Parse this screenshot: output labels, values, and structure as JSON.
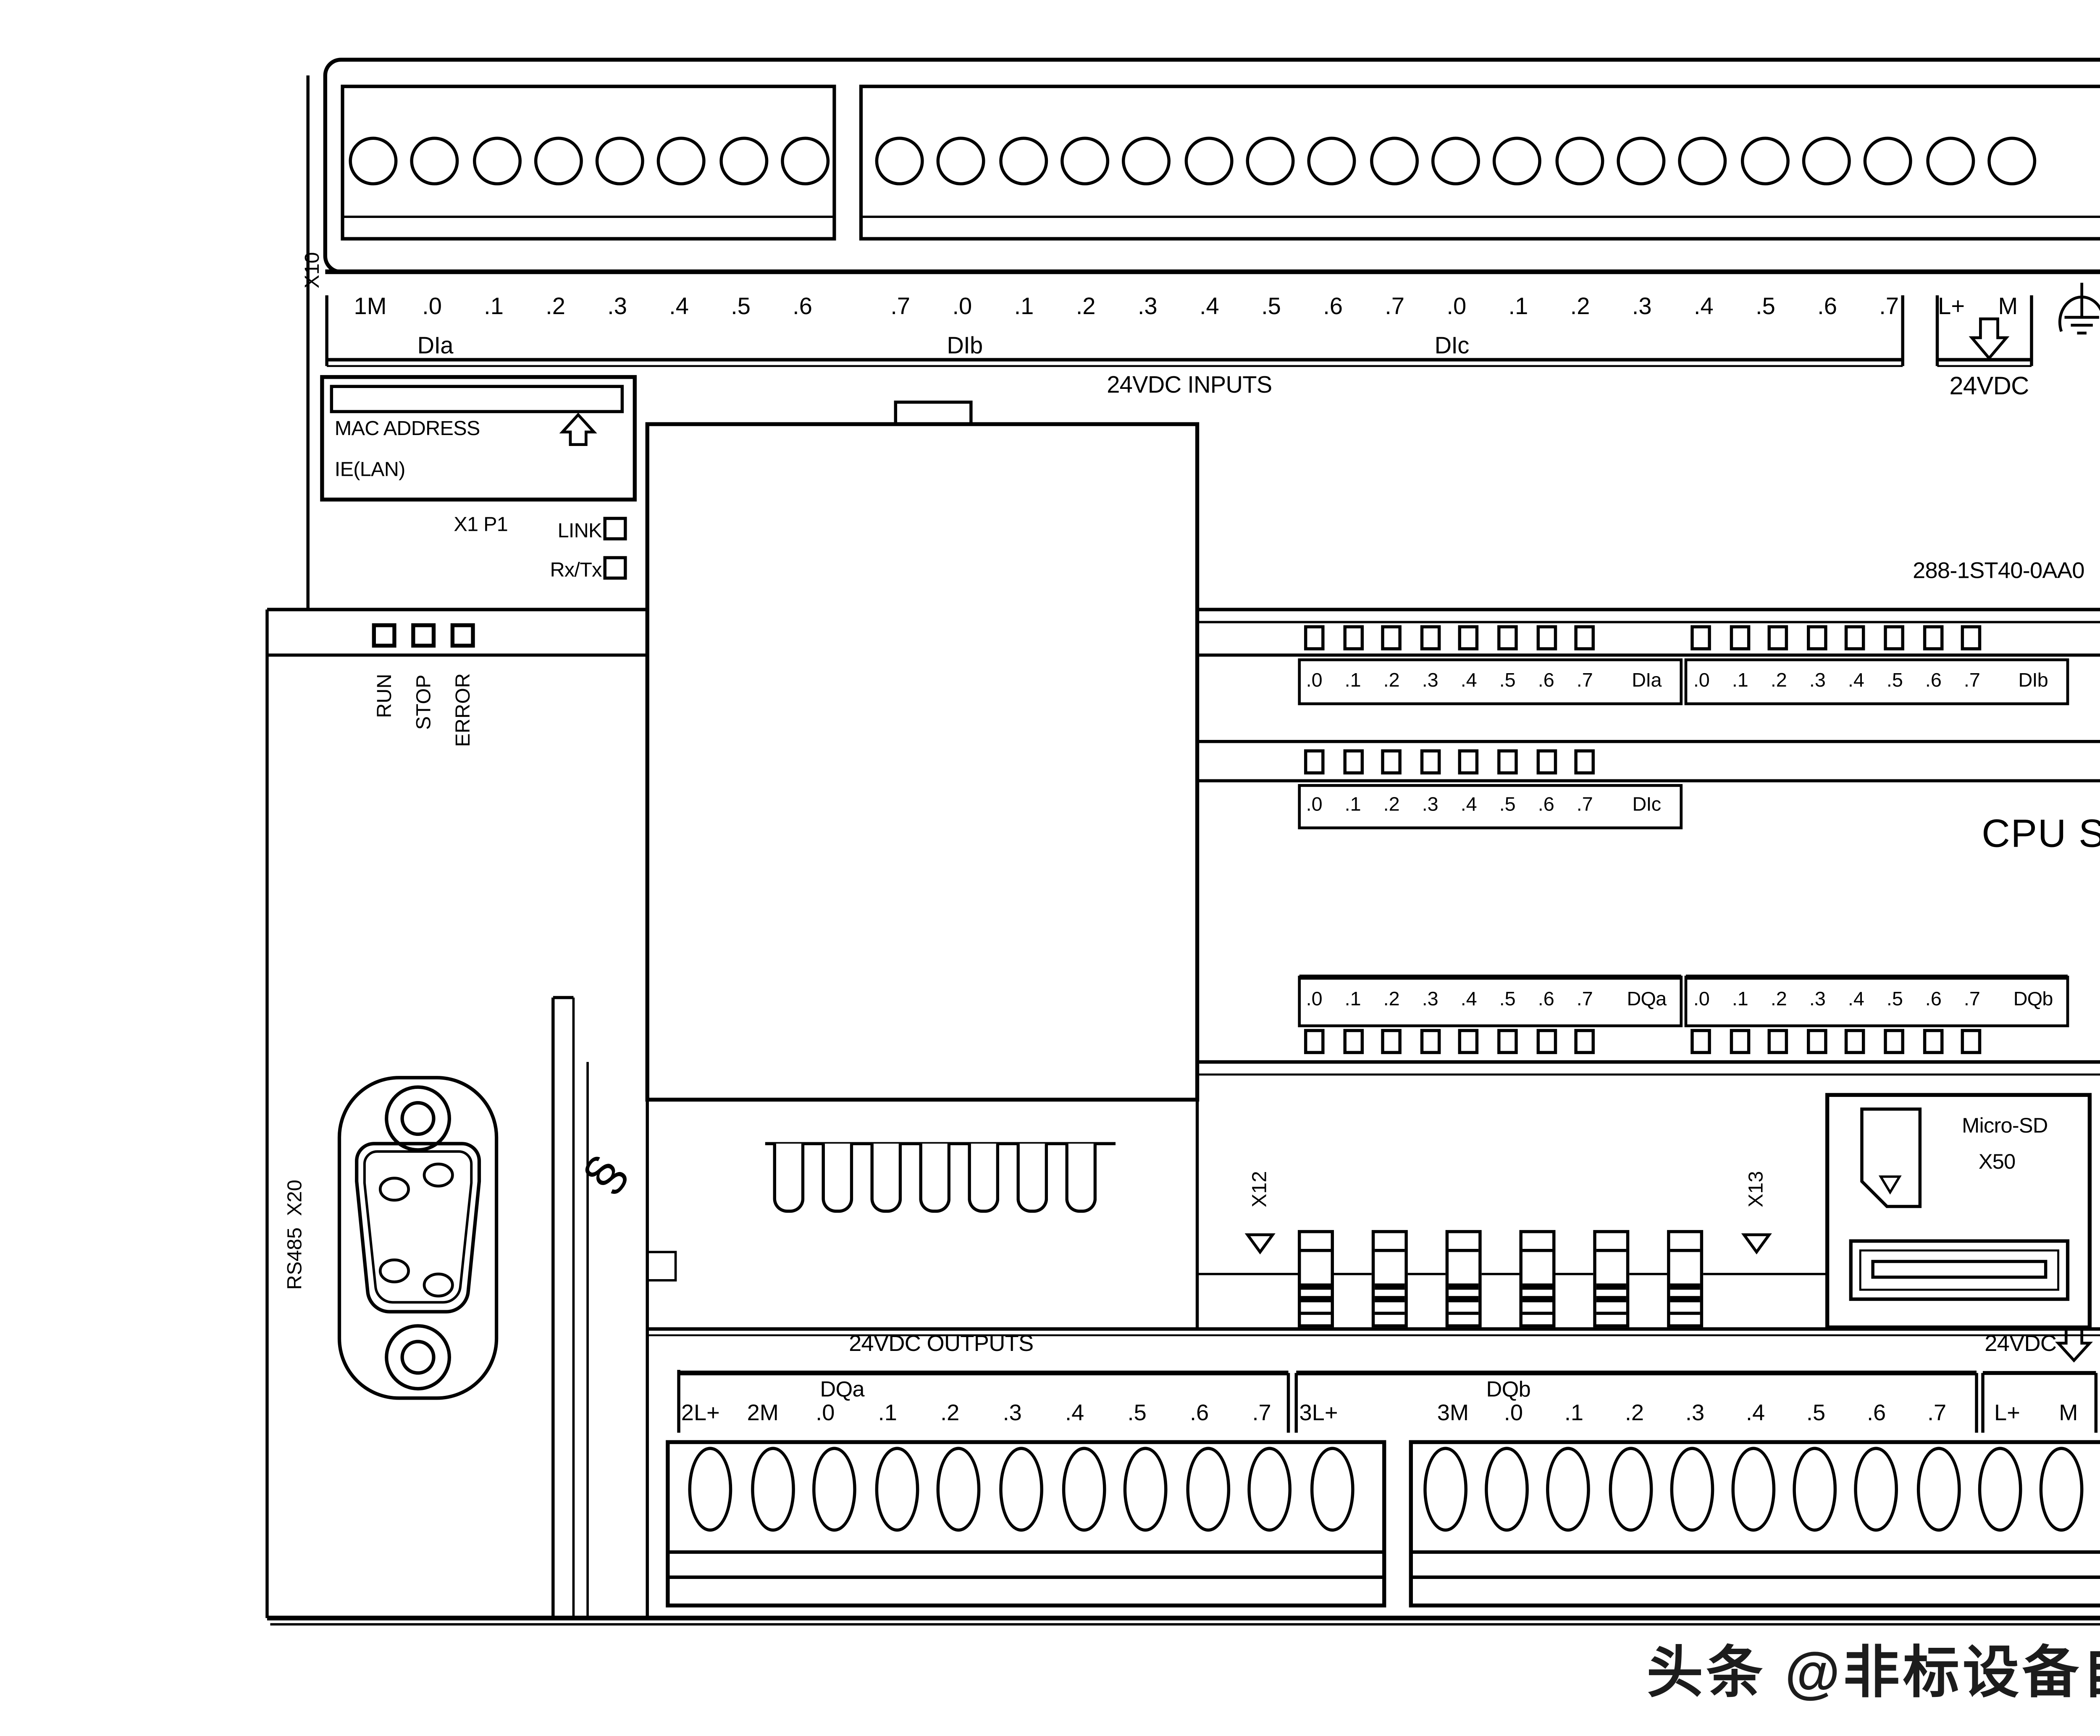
{
  "top": {
    "x10": "X10",
    "x11": "X11",
    "labels_a": [
      "1M",
      ".0",
      ".1",
      ".2",
      ".3",
      ".4",
      ".5",
      ".6"
    ],
    "labels_b": [
      ".7",
      ".0",
      ".1",
      ".2",
      ".3",
      ".4",
      ".5",
      ".6",
      ".7",
      ".0",
      ".1",
      ".2",
      ".3",
      ".4",
      ".5",
      ".6",
      ".7"
    ],
    "supply_labels": [
      "L+",
      "M"
    ],
    "dia": "DIa",
    "dib": "DIb",
    "dic": "DIc",
    "inputs_caption": "24VDC INPUTS",
    "supply_caption": "24VDC"
  },
  "ethernet": {
    "mac": "MAC ADDRESS",
    "ie": "IE(LAN)",
    "port": "X1 P1",
    "link": "LINK",
    "rxtx": "Rx/Tx"
  },
  "status": {
    "leds": [
      "RUN",
      "STOP",
      "ERROR"
    ]
  },
  "article_number": "288-1ST40-0AA0",
  "cpu_name": "CPU ST40",
  "led_banks": {
    "bits": [
      ".0",
      ".1",
      ".2",
      ".3",
      ".4",
      ".5",
      ".6",
      ".7"
    ],
    "dia": "DIa",
    "dib": "DIb",
    "dic": "DIc",
    "dqa": "DQa",
    "dqb": "DQb"
  },
  "expansion": {
    "x12": "X12",
    "x13": "X13"
  },
  "sd": {
    "name": "Micro-SD",
    "port": "X50"
  },
  "serial": {
    "label": "RS485  X20"
  },
  "din_clip_symbol": "§",
  "outputs": {
    "caption": "24VDC OUTPUTS",
    "dqa": "DQa",
    "dqb": "DQb",
    "dqa_terminals": [
      "2L+",
      "2M",
      ".0",
      ".1",
      ".2",
      ".3",
      ".4",
      ".5",
      ".6",
      ".7"
    ],
    "dqb_terminals": [
      "3L+",
      "3M",
      ".0",
      ".1",
      ".2",
      ".3",
      ".4",
      ".5",
      ".6",
      ".7"
    ],
    "supply_caption": "24VDC",
    "supply_terminals": [
      "L+",
      "M"
    ]
  },
  "watermark": "头条 @非标设备自动化设计",
  "colors": {
    "line": "#000000",
    "background": "#ffffff",
    "watermark": "#1c1c1c"
  }
}
